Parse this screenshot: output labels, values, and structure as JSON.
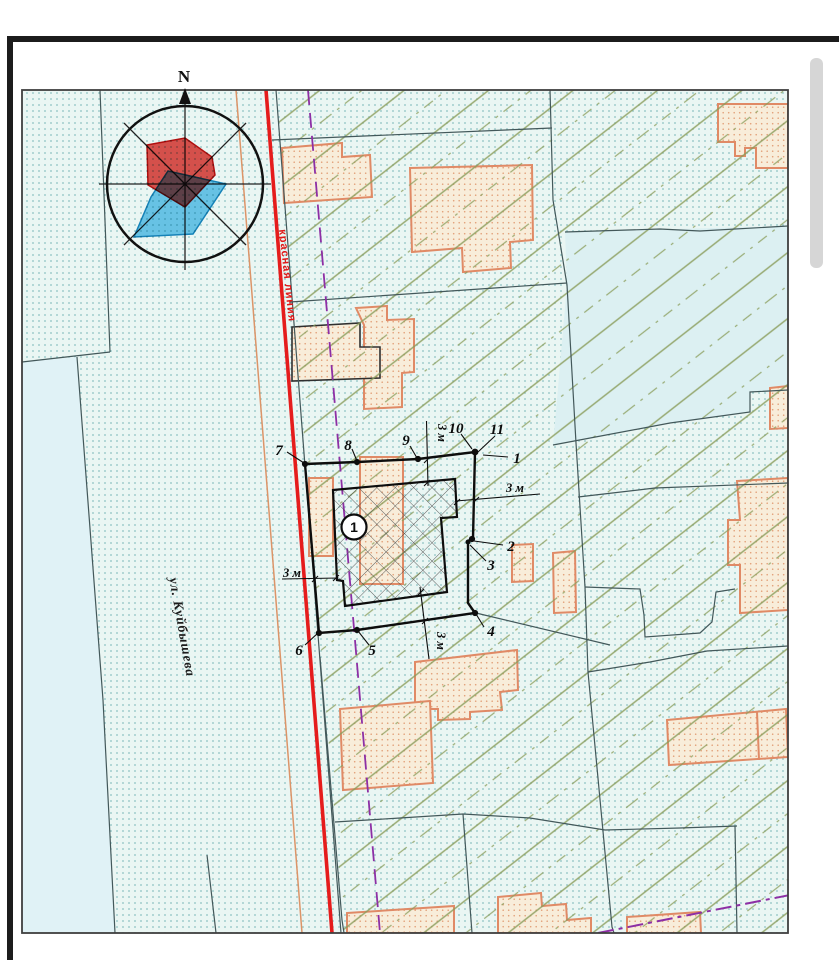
{
  "map": {
    "compass": {
      "north_label": "N"
    },
    "red_line_label": "красная линия",
    "street_label": "ул. Куйбышева",
    "plot": {
      "building_label": "1",
      "points": [
        {
          "label": "7"
        },
        {
          "label": "8"
        },
        {
          "label": "9"
        },
        {
          "label": "10"
        },
        {
          "label": "11"
        },
        {
          "label": "1"
        },
        {
          "label": "2"
        },
        {
          "label": "3"
        },
        {
          "label": "4"
        },
        {
          "label": "5"
        },
        {
          "label": "6"
        }
      ],
      "setbacks": [
        {
          "label": "3 м"
        },
        {
          "label": "3 м"
        },
        {
          "label": "3 м"
        },
        {
          "label": "3 м"
        }
      ]
    },
    "colors": {
      "map_background": "#eaf6f3",
      "plain_parcel": "#dcf0f2",
      "dot_grid": "#85bdbd",
      "hatch_green": "#8a9c5a",
      "parcel_line": "#43585a",
      "building_outline": "#e08a66",
      "building_fill": "#f8edda",
      "red_line": "#e51c1c",
      "roadside_line": "#dc9468",
      "boundary_dashed": "#8d2fa5",
      "plot_line": "#0d0d0d",
      "compass_red": "#e43b36",
      "compass_blue": "#57bfed",
      "frame": "#1c1c1c",
      "scrollbar": "#d6d6d6"
    }
  }
}
